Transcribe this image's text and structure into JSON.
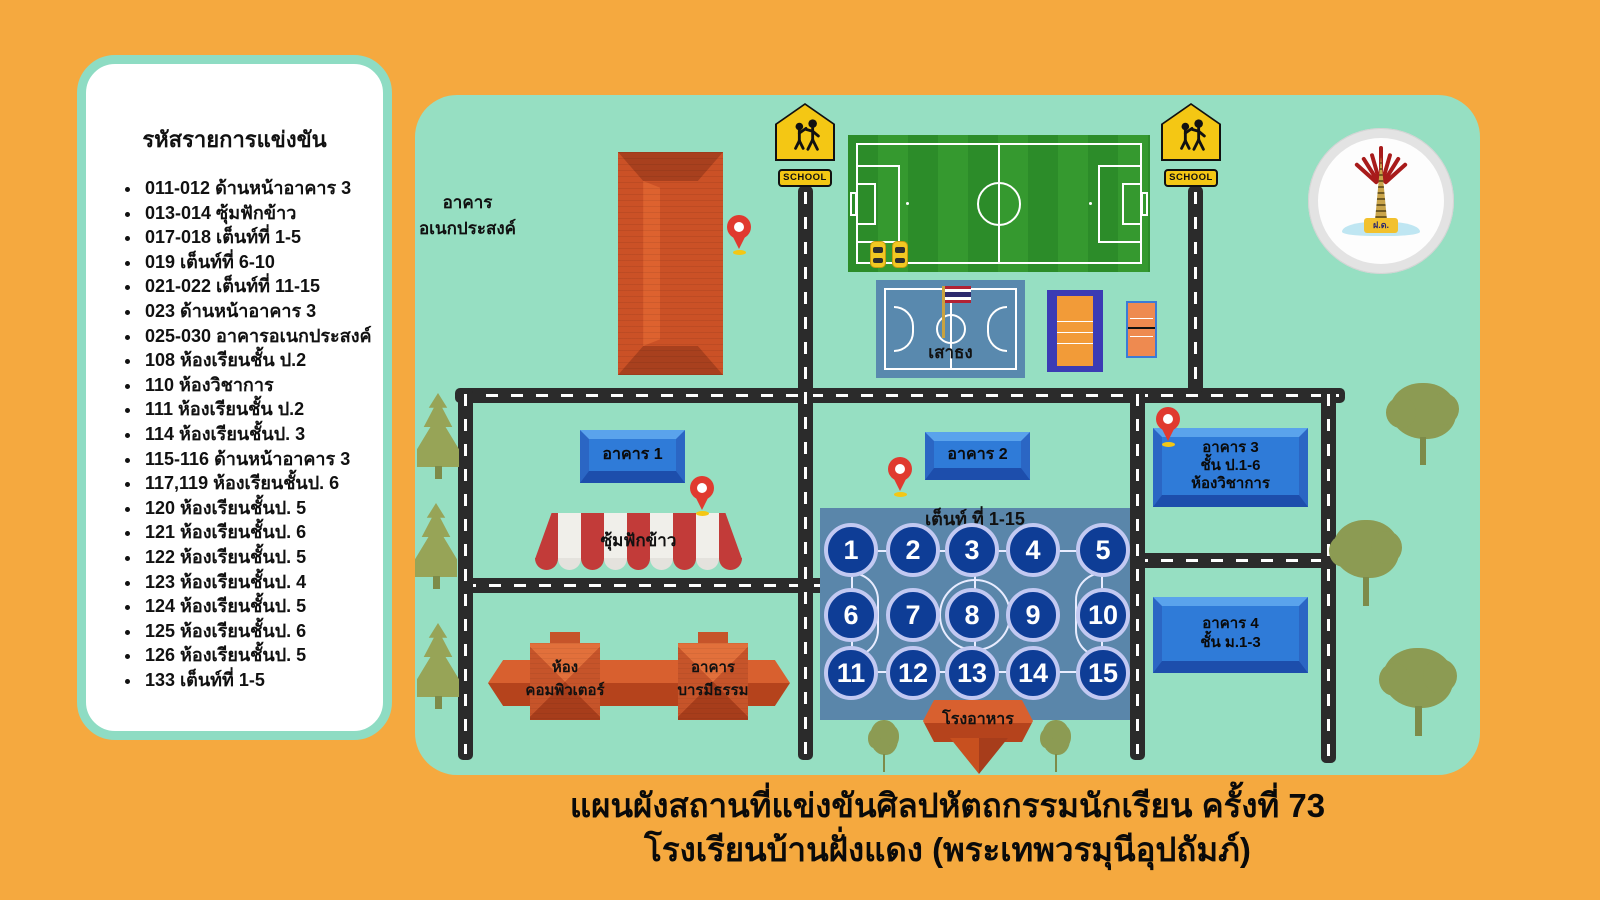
{
  "legend": {
    "title": "รหัสรายการแข่งขัน",
    "items": [
      "011-012 ด้านหน้าอาคาร 3",
      "013-014 ซุ้มฟักข้าว",
      "017-018 เต็นท์ที่ 1-5",
      "019 เต็นท์ที่ 6-10",
      "021-022 เต็นท์ที่ 11-15",
      "023 ด้านหน้าอาคาร 3",
      "025-030 อาคารอเนกประสงค์",
      "108 ห้องเรียนชั้น ป.2",
      "110 ห้องวิชาการ",
      "111 ห้องเรียนชั้น ป.2",
      "114 ห้องเรียนชั้นป. 3",
      "115-116 ด้านหน้าอาคาร 3",
      "117,119 ห้องเรียนชั้นป. 6",
      "120 ห้องเรียนชั้นป. 5",
      "121 ห้องเรียนชั้นป. 6",
      "122 ห้องเรียนชั้นป. 5",
      "123 ห้องเรียนชั้นป. 4",
      "124 ห้องเรียนชั้นป. 5",
      "125 ห้องเรียนชั้นป. 6",
      "126 ห้องเรียนชั้นป. 5",
      "133 เต็นท์ที่ 1-5"
    ]
  },
  "map": {
    "school_sign": "SCHOOL",
    "multipurpose_building": {
      "line1": "อาคาร",
      "line2": "อเนกประสงค์"
    },
    "flagpole_label": "เสาธง",
    "building1": "อาคาร 1",
    "building2": "อาคาร 2",
    "building3": {
      "line1": "อาคาร 3",
      "line2": "ชั้น ป.1-6",
      "line3": "ห้องวิชาการ"
    },
    "building4": {
      "line1": "อาคาร 4",
      "line2": "ชั้น ม.1-3"
    },
    "rice_pavilion": "ซุ้มฟักข้าว",
    "tents_label": "เต็นท์ ที่ 1-15",
    "tent_numbers": [
      1,
      2,
      3,
      4,
      5,
      6,
      7,
      8,
      9,
      10,
      11,
      12,
      13,
      14,
      15
    ],
    "computer_room": {
      "line1": "ห้อง",
      "line2": "คอมพิวเตอร์"
    },
    "baramitham_building": {
      "line1": "อาคาร",
      "line2": "บารมีธรรม"
    },
    "cafeteria": "โรงอาหาร",
    "logo_monogram": "ฝ.ด."
  },
  "footer": {
    "line1": "แผนผังสถานที่แข่งขันศิลปหัตถกรรมนักเรียน ครั้งที่ 73",
    "line2": "โรงเรียนบ้านฝั่งแดง (พระเทพวรมุนีอุปถัมภ์)"
  },
  "colors": {
    "background_orange": "#F5A93F",
    "map_mint": "#96DFC2",
    "road_black": "#2B2B2B",
    "sign_blue": "#2F7BD8",
    "roof_orange": "#CB5126",
    "awning_red": "#C23B39",
    "court_steel_blue": "#5A86AA",
    "tent_circle_navy": "#0E3D96",
    "field_green": "#2C8C29",
    "school_sign_yellow": "#F4C714"
  }
}
